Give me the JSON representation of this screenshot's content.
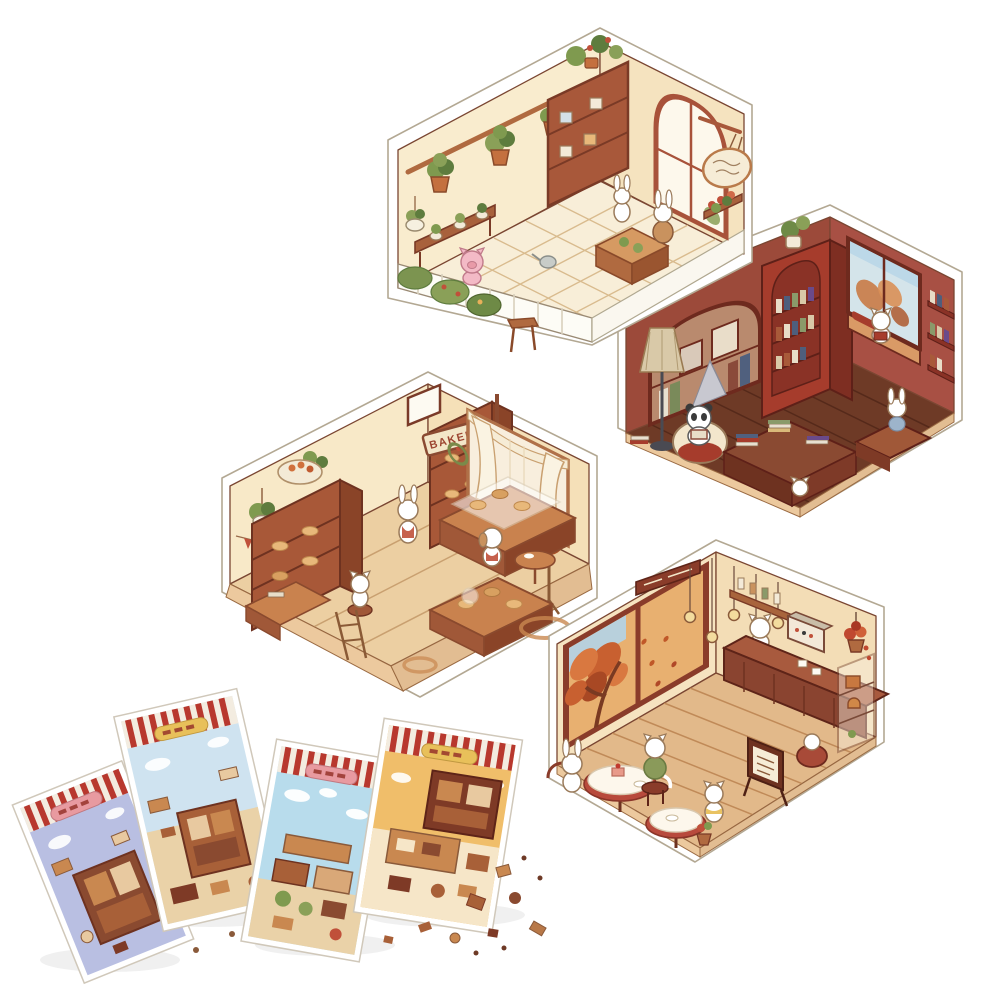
{
  "alt": "Product photo of a DIY miniature kit: four isometric hexagonal dollhouse rooms (plant shop, bookstore, bakery, cafe) with small white animal characters, plus four striped sticker sheets and loose sticker pieces scattered at the lower left",
  "signs": {
    "bakery": "BAKERY"
  },
  "rooms": {
    "plant_shop": {
      "label": "plant shop room"
    },
    "bookstore": {
      "label": "bookstore room"
    },
    "bakery": {
      "label": "bakery room"
    },
    "cafe": {
      "label": "cafe room"
    }
  },
  "sticker_sheets": {
    "count": 4
  },
  "colors": {
    "background": "#ffffff",
    "outline": "#7a4632",
    "acrylic_edge": "#b3a893",
    "garden_wall": "#f9ecce",
    "garden_wall_right": "#f5e3bf",
    "garden_floor": "#f8eed8",
    "tile_line": "#d9bb8e",
    "fence_white": "#fdfcf6",
    "wood": "#a8583a",
    "wood_dark": "#7e3a26",
    "wood_light": "#d69a62",
    "leaf_green": "#7f9a4f",
    "leaf_dark": "#5e7c3e",
    "leaf_light": "#8aa058",
    "flower_red": "#c0503a",
    "pig_pink": "#f3bac6",
    "book_wall": "#9c4a3a",
    "book_wall_right": "#a85044",
    "book_shelf_red": "#a63c2c",
    "book_floor": "#6e3a26",
    "plank_line": "#55291a",
    "base_tan": "#ecc99e",
    "niche_tan": "#b98a6e",
    "window_sky": "#d4e4ea",
    "autumn": "#c97a46",
    "bakery_wall": "#f8e9c8",
    "bakery_wall_right": "#f5e0b8",
    "bakery_floor": "#eccfa2",
    "bakery_plank": "#c9a070",
    "counter_top": "#c9824e",
    "bread_tan": "#e8b87a",
    "curtain": "#faf3e2",
    "pumpkin": "#d07038",
    "cafe_wall": "#f6e3c0",
    "cafe_wall_right": "#f3ddb6",
    "cafe_floor": "#e2b98a",
    "cafe_frame": "#8a3c2a",
    "cafe_glow": "#e8b070",
    "sky_blue": "#b8d0dc",
    "autumn_deep": "#c86030",
    "counter_front": "#8a4430",
    "bulb": "#f3dc9e",
    "cloth_white": "#fdf7ec",
    "cloth_red": "#b84a3c",
    "sweater_green": "#8a9a5a",
    "lamp_shade": "#d9c9a8",
    "panda_black": "#3a3a3a",
    "character_white": "#ffffff",
    "character_outline": "#9a7a5a",
    "stripe_red": "#b8382e",
    "stripe_cream": "#f3ece0",
    "sheet1_bg": "#b9bfe2",
    "sheet2_bg": "#cfe3f0",
    "sheet3_bg": "#b8dcec",
    "sheet4_bg": "#f0be6a",
    "sheet_tan": "#ead2a8",
    "banner_yellow": "#e8c05a",
    "banner_pink": "#e89aa0",
    "sticker_brown": "#a86038",
    "sticker_tan": "#c98850"
  }
}
